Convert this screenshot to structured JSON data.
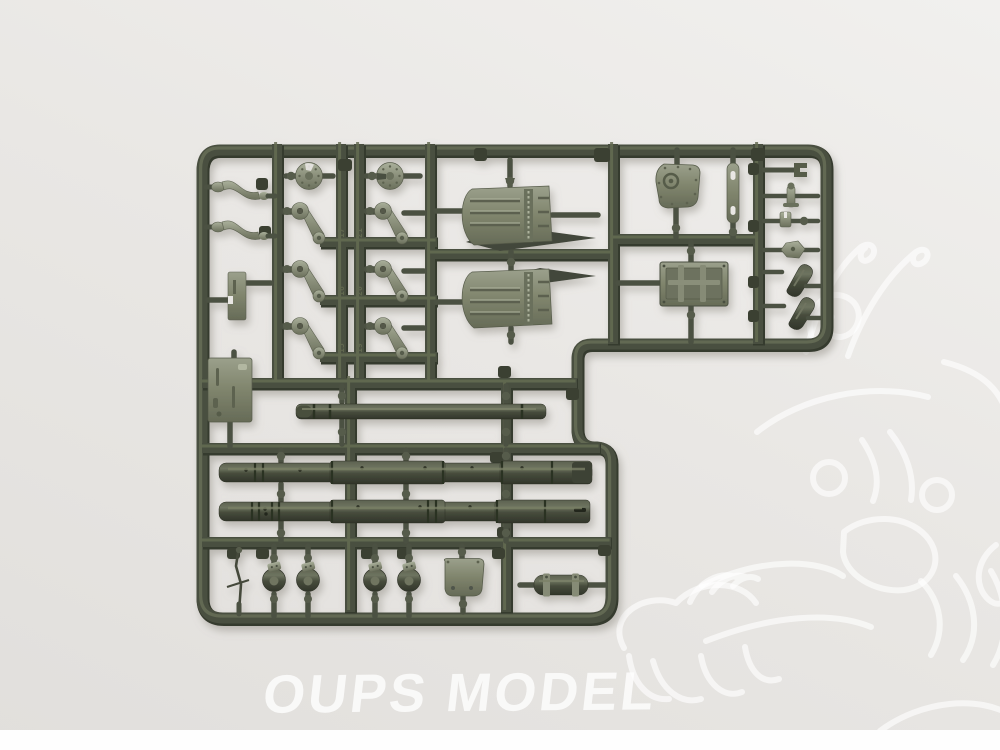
{
  "photo": {
    "watermark_text": "OUPS MODEL"
  },
  "colors": {
    "bg-top": "#f1f0ee",
    "bg-mid": "#e9e7e4",
    "bg-bottom": "#e1dfdc",
    "bottom-strip": "#fefefe",
    "runner-dark": "#363a2d",
    "runner-mid": "#4a4f40",
    "runner-light": "#656b54",
    "part-light": "#a6ab97",
    "part-mid": "#7a7f6b",
    "part-dark": "#4f5445",
    "barrel-dark": "#3a3e31",
    "watermark": "#ffffff"
  },
  "sprue": {
    "material": "olive green styrene",
    "part_numbers": [
      "17",
      "21",
      "16",
      "20",
      "15",
      "19"
    ],
    "parts": [
      {
        "label": "curved tow hook",
        "qty": 2
      },
      {
        "label": "wheel disc",
        "qty": 2
      },
      {
        "label": "suspension arm",
        "qty": 6
      },
      {
        "label": "small plate",
        "qty": 1
      },
      {
        "label": "access panel",
        "qty": 1
      },
      {
        "label": "louvered fender",
        "qty": 2
      },
      {
        "label": "round hatch cover",
        "qty": 1
      },
      {
        "label": "hinge strip",
        "qty": 1
      },
      {
        "label": "rear door panel",
        "qty": 1
      },
      {
        "label": "small fitting",
        "qty": 6
      },
      {
        "label": "short gun barrel",
        "qty": 1
      },
      {
        "label": "long gun barrel",
        "qty": 2
      },
      {
        "label": "wire rod",
        "qty": 1
      },
      {
        "label": "barrel clamp",
        "qty": 4
      },
      {
        "label": "base plate",
        "qty": 1
      },
      {
        "label": "exhaust cylinder",
        "qty": 1
      }
    ]
  }
}
